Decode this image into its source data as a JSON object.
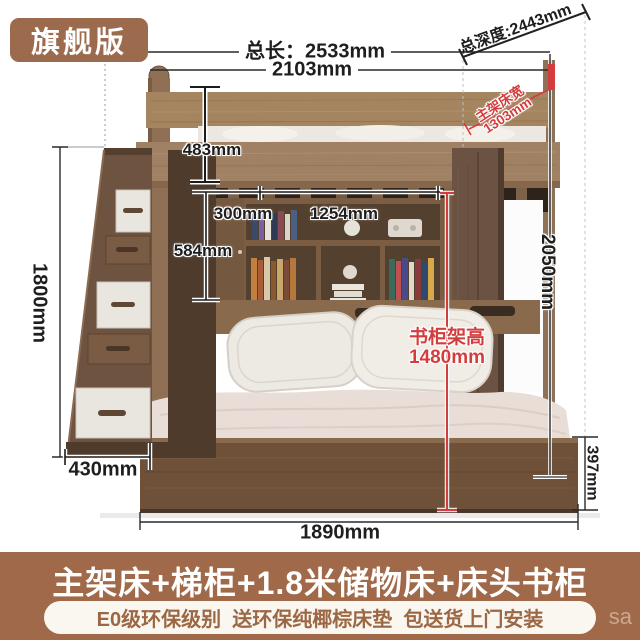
{
  "badge": {
    "label": "旗舰版"
  },
  "annotations": {
    "total_length": "总长：2533mm",
    "upper_length": "2103mm",
    "total_depth": "总深度:2443mm",
    "bed_width_line1": "主架床宽",
    "bed_width_line2": "1303mm",
    "rail_height": "483mm",
    "shelf_left_width": "300mm",
    "shelf_width": "1254mm",
    "shelf_height": "584mm",
    "stair_height": "1800mm",
    "stair_depth": "430mm",
    "bookcase_height_line1": "书柜架高",
    "bookcase_height_line2": "1480mm",
    "frame_height": "2050mm",
    "base_height": "397mm",
    "bed_length": "1890mm"
  },
  "banner": {
    "title": "主架床+梯柜+1.8米储物床+床头书柜",
    "subtitle": "E0级环保级别  送环保纯椰棕床垫  包送货上门安装",
    "watermark": "sa"
  },
  "colors": {
    "accent_red": "#d43d3d",
    "brand_brown": "#a06a4a",
    "badge_brown": "#9c6b4e"
  }
}
